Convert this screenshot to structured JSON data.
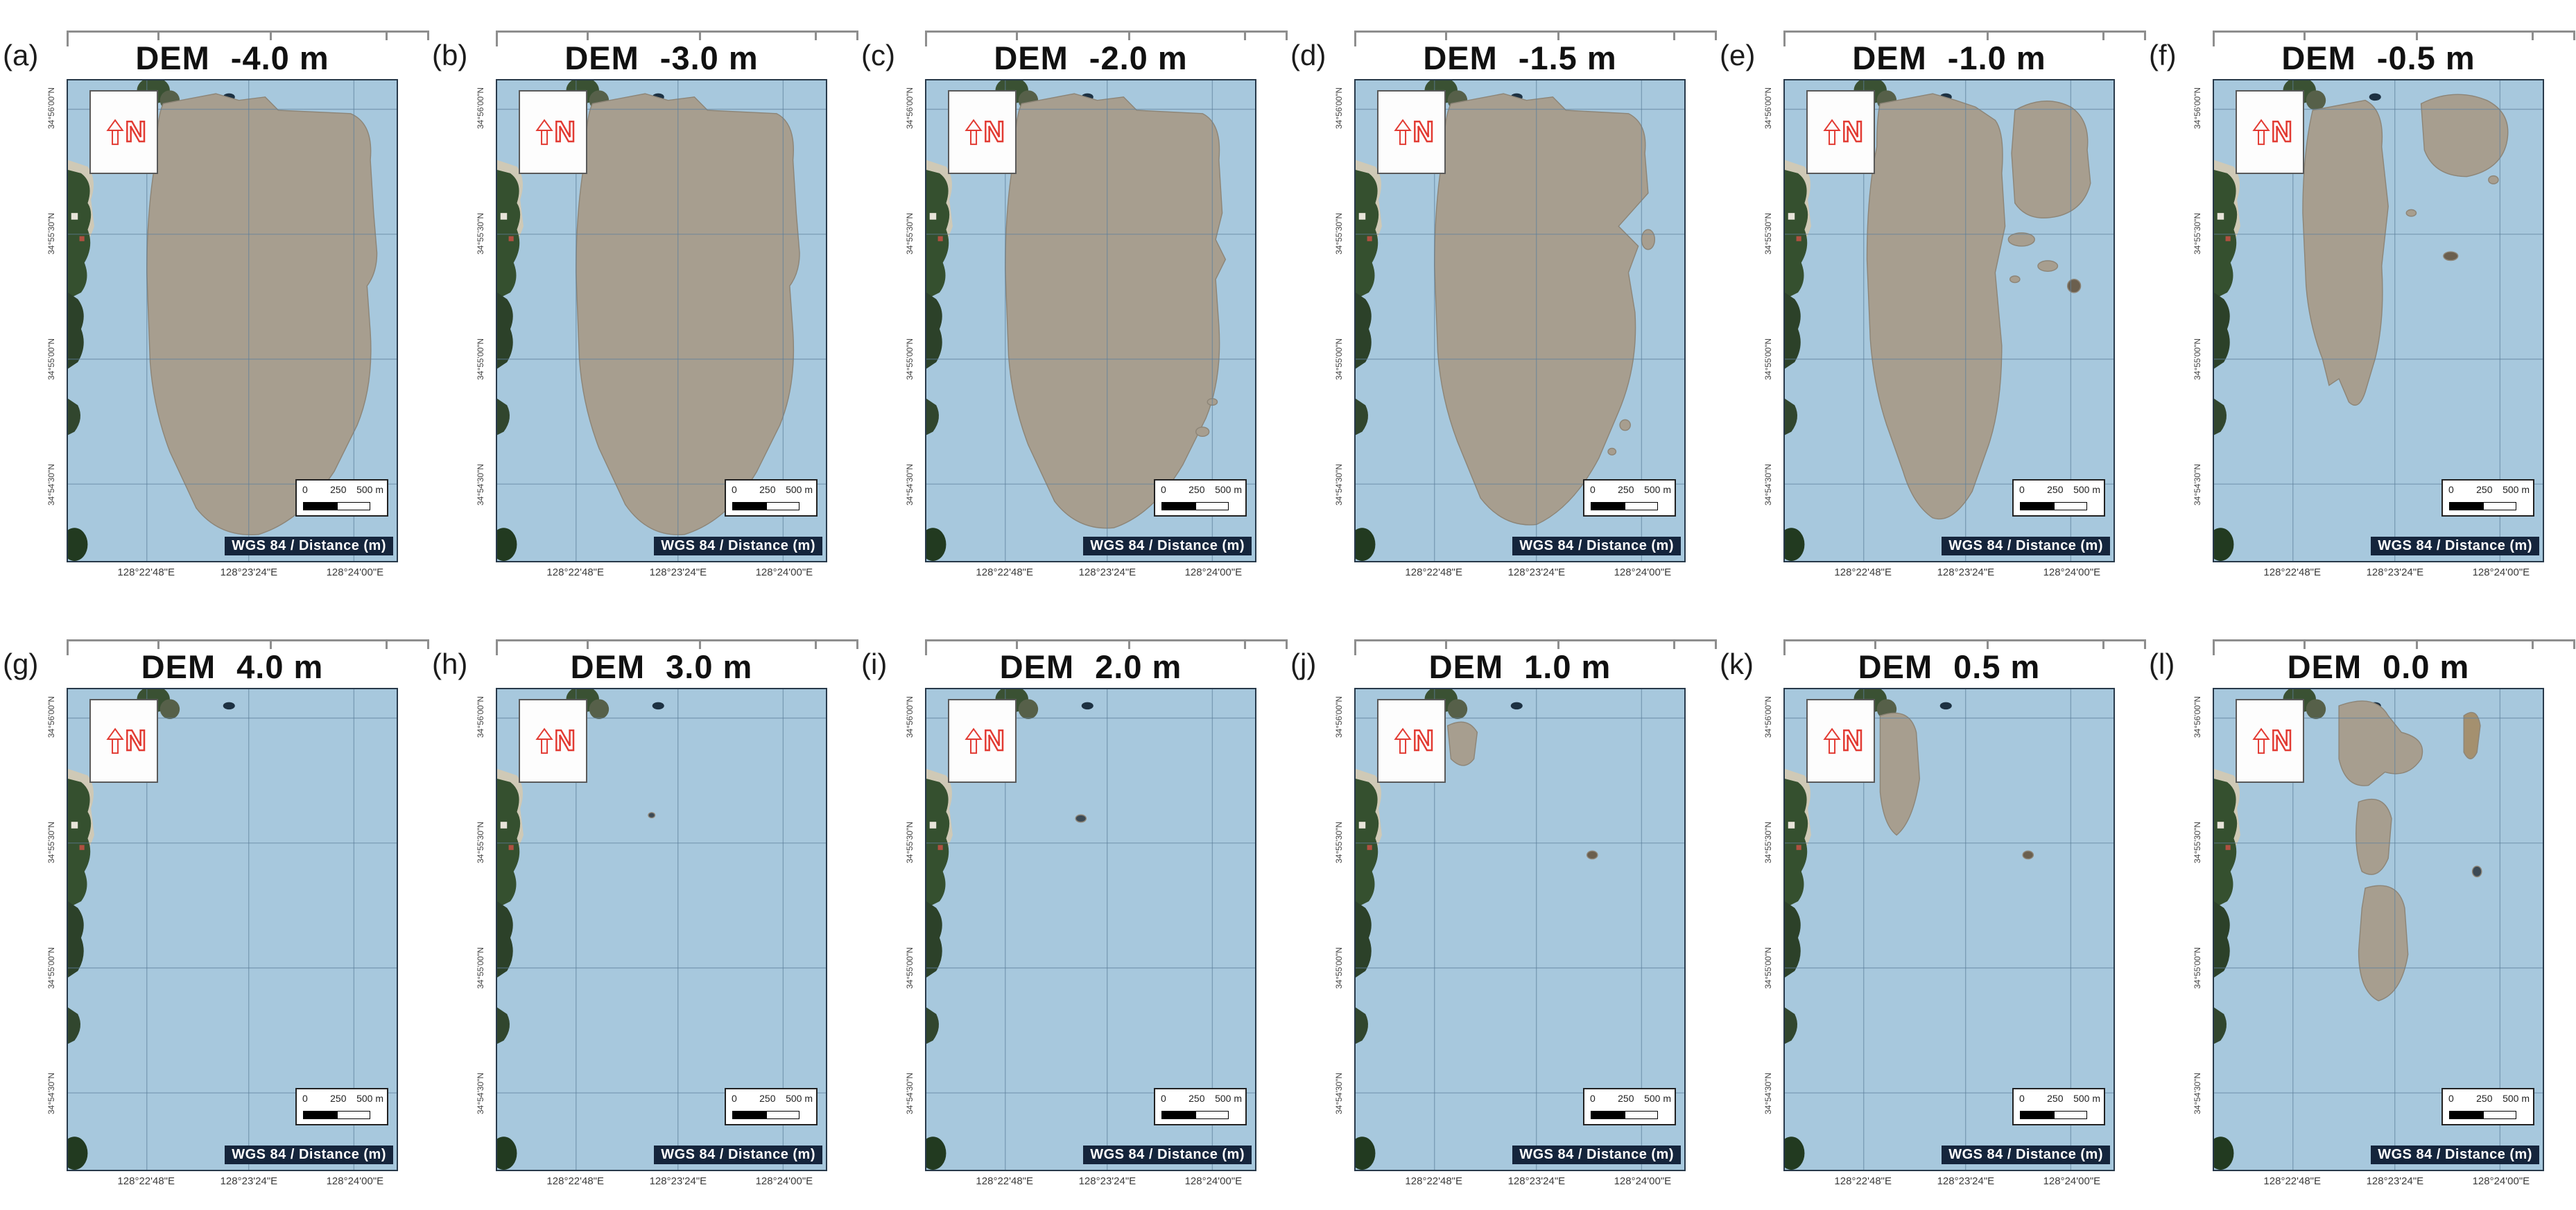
{
  "figure": {
    "panels": [
      {
        "label": "(a)",
        "elevation": "-4.0 m"
      },
      {
        "label": "(b)",
        "elevation": "-3.0 m"
      },
      {
        "label": "(c)",
        "elevation": "-2.0 m"
      },
      {
        "label": "(d)",
        "elevation": "-1.5 m"
      },
      {
        "label": "(e)",
        "elevation": "-1.0 m"
      },
      {
        "label": "(f)",
        "elevation": "-0.5 m"
      },
      {
        "label": "(g)",
        "elevation": "4.0 m"
      },
      {
        "label": "(h)",
        "elevation": "3.0 m"
      },
      {
        "label": "(i)",
        "elevation": "2.0 m"
      },
      {
        "label": "(j)",
        "elevation": "1.0 m"
      },
      {
        "label": "(k)",
        "elevation": "0.5 m"
      },
      {
        "label": "(l)",
        "elevation": "0.0 m"
      }
    ],
    "map": {
      "dem_label": "DEM",
      "north_label": "N",
      "crs_label": "WGS 84 / Distance (m)",
      "scalebar": [
        "0",
        "250",
        "500 m"
      ],
      "lon_ticks": [
        "128°22'48\"E",
        "128°23'24\"E",
        "128°24'00\"E"
      ],
      "lat_ticks": [
        "34°56'00\"N",
        "34°55'30\"N",
        "34°55'00\"N",
        "34°54'30\"N"
      ],
      "colors": {
        "water": "#a7c8dd",
        "tidal_flat_sand": "#a79e8f",
        "coast_vegetation": "#35502f",
        "north_arrow_red": "#e23b33",
        "grid_line": "#5d7f9b",
        "crs_strip_bg": "#15253c"
      }
    }
  }
}
